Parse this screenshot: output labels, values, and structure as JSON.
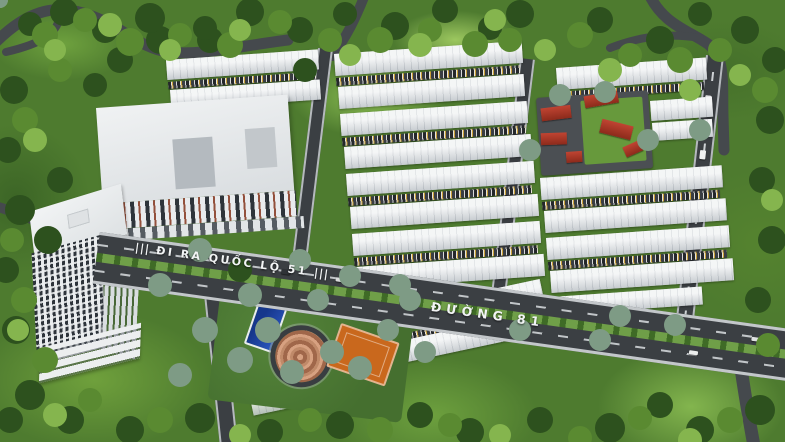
{
  "scene": {
    "description": "Aerial 3D masterplan rendering of a residential development with townhouse rows, high-rise tower, apartment block, school with red roofs, central park and tree-lined roads",
    "road_labels": {
      "ql51": {
        "marks_left": "|||",
        "text": "ĐI RA QUỐC LỘ 51",
        "marks_right": "|||"
      },
      "duong81": {
        "text": "ĐƯỜNG 81"
      }
    },
    "palette": {
      "forest_green": "#4e7b2f",
      "light_green": "#85b54e",
      "asphalt": "#3b3f43",
      "roof_white": "#e7eaec",
      "red_roof": "#b23a28",
      "court_orange": "#c9681d",
      "pool_blue": "#16378c",
      "spiral_copper": "#c98e6e",
      "median_green": "#5e8c3b",
      "label_white": "#f2f4f5"
    }
  }
}
